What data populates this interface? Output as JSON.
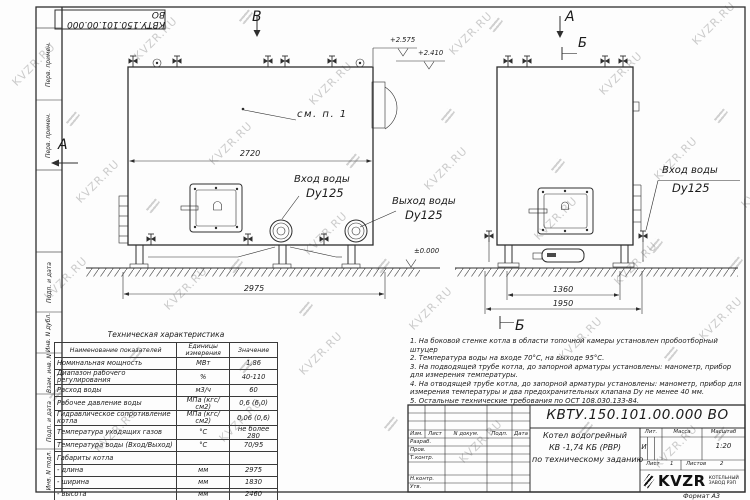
{
  "watermark": {
    "text": "KVZR.RU"
  },
  "frame": {
    "doc_number_top": "КВТУ.150.101.00.000 ВО",
    "stamps_left": [
      "Перв. примен.",
      "Перв. примен.",
      "Подп. и дата",
      "Инв. N дубл.",
      "Взам. инв. N",
      "Подп. и дата",
      "Инв. N подл."
    ],
    "format_label": "Формат  А3"
  },
  "views": {
    "left": {
      "label_b": "В",
      "label_a": "А",
      "see_note": "см. п. 1",
      "dim_top": "2720",
      "dim_bottom": "2975",
      "level_top": "+2.575",
      "level_mid": "+2.410",
      "level_zero": "±0.000",
      "inlet_label": "Вход воды",
      "inlet_dn": "Dy125",
      "outlet_label": "Выход воды",
      "outlet_dn": "Dy125"
    },
    "right": {
      "label_a": "А",
      "section_top": "Б",
      "section_bottom": "Б",
      "dim_inner": "1360",
      "dim_outer": "1950",
      "inlet_label": "Вход воды",
      "inlet_dn": "Dy125"
    }
  },
  "spec_table": {
    "title": "Техническая характеристика",
    "headers": [
      "Наименование показателей",
      "Единицы измерения",
      "Значение"
    ],
    "rows": [
      [
        "Номинальная мощность",
        "МВт",
        "1,86"
      ],
      [
        "Диапазон рабочего регулирования",
        "%",
        "40-110"
      ],
      [
        "Расход воды",
        "м3/ч",
        "60"
      ],
      [
        "Рабочее давление воды",
        "МПа (кгс/см2)",
        "0,6 (6,0)"
      ],
      [
        "Гидравлическое сопротивление котла",
        "МПа (кгс/см2)",
        "0,06 (0,6)"
      ],
      [
        "Температура уходящих газов",
        "°С",
        "не более 280"
      ],
      [
        "Температура воды (Вход/Выход)",
        "°С",
        "70/95"
      ],
      [
        "Габариты котла",
        "",
        ""
      ],
      [
        "   - длина",
        "мм",
        "2975"
      ],
      [
        "   - ширина",
        "мм",
        "1830"
      ],
      [
        "   - высота",
        "мм",
        "2460"
      ]
    ]
  },
  "notes": [
    "1.  На боковой стенке котла в области топочной камеры установлен пробоотборный штуцер",
    "2.  Температура воды на входе 70°С, на выходе 95°С.",
    "3.  На подводящей трубе котла, до запорной арматуры установлены: манометр, прибор для измерения температуры.",
    "4.  На отводящей трубе котла, до запорной арматуры установлены: манометр, прибор для измерения температуры и два предохранительных клапана Dу не менее 40 мм.",
    "5.  Остальные технические требования по ОСТ 108.030.133-84."
  ],
  "title_block": {
    "doc_number": "КВТУ.150.101.00.000  ВО",
    "col_izm": "Изм.",
    "col_list": "Лист",
    "col_doc": "N докум.",
    "col_sign": "Подп.",
    "col_date": "Дата",
    "row_razrab": "Разраб.",
    "row_prov": "Пров.",
    "row_tkontr": "Т.контр.",
    "row_nkontr": "Н.контр.",
    "row_utv": "Утв.",
    "name_line1": "Котел водогрейный",
    "name_line2": "КВ -1,74  КБ  (РВР)",
    "name_line3": "по техническому заданию",
    "lit_header": "Лит.",
    "mass_header": "Масса",
    "scale_header": "Масштаб",
    "lit_value": "И",
    "scale_value": "1:20",
    "sheet_label": "Лист",
    "sheet_value": "1",
    "sheets_label": "Листов",
    "sheets_value": "2",
    "company": "KVZR",
    "company_sub1": "КОТЕЛЬНЫЙ",
    "company_sub2": "ЗАВОД РЭП"
  },
  "colors": {
    "line": "#2e2e2e",
    "watermark": "#bfbfbf",
    "paper": "#fdfdfd"
  }
}
